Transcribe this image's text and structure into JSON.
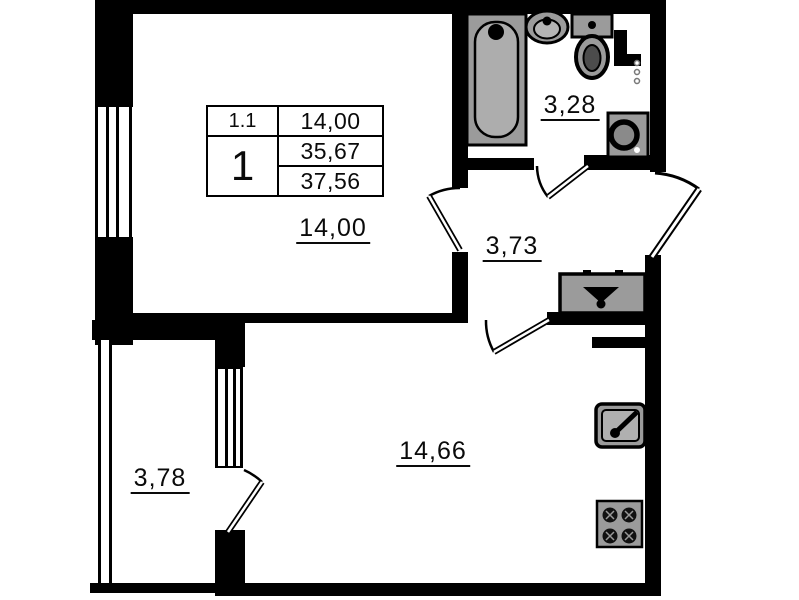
{
  "title": "Apartment floor plan 1-room",
  "info_table": {
    "unit": "1.1",
    "living_room_area": "14,00",
    "rooms_count": "1",
    "area_without_balcony": "35,67",
    "total_area": "37,56"
  },
  "rooms": {
    "bedroom": {
      "label": "14,00"
    },
    "bathroom": {
      "label": "3,28"
    },
    "hallway": {
      "label": "3,73"
    },
    "kitchen_living": {
      "label": "14,66"
    },
    "balcony": {
      "label": "3,78"
    }
  },
  "icons": {
    "bathtub": "bathtub-icon",
    "sink": "sink-icon",
    "toilet": "toilet-icon",
    "washing_machine": "washing-machine-icon",
    "wardrobe": "wardrobe-hanger-icon",
    "kitchen_sink": "kitchen-sink-icon",
    "stove": "stove-icon",
    "vent": "vent-dots-icon"
  },
  "colors": {
    "wall": "#000000",
    "fixture_fill": "#9b9b9b",
    "fixture_light": "#b0b0b0",
    "background": "#ffffff"
  }
}
